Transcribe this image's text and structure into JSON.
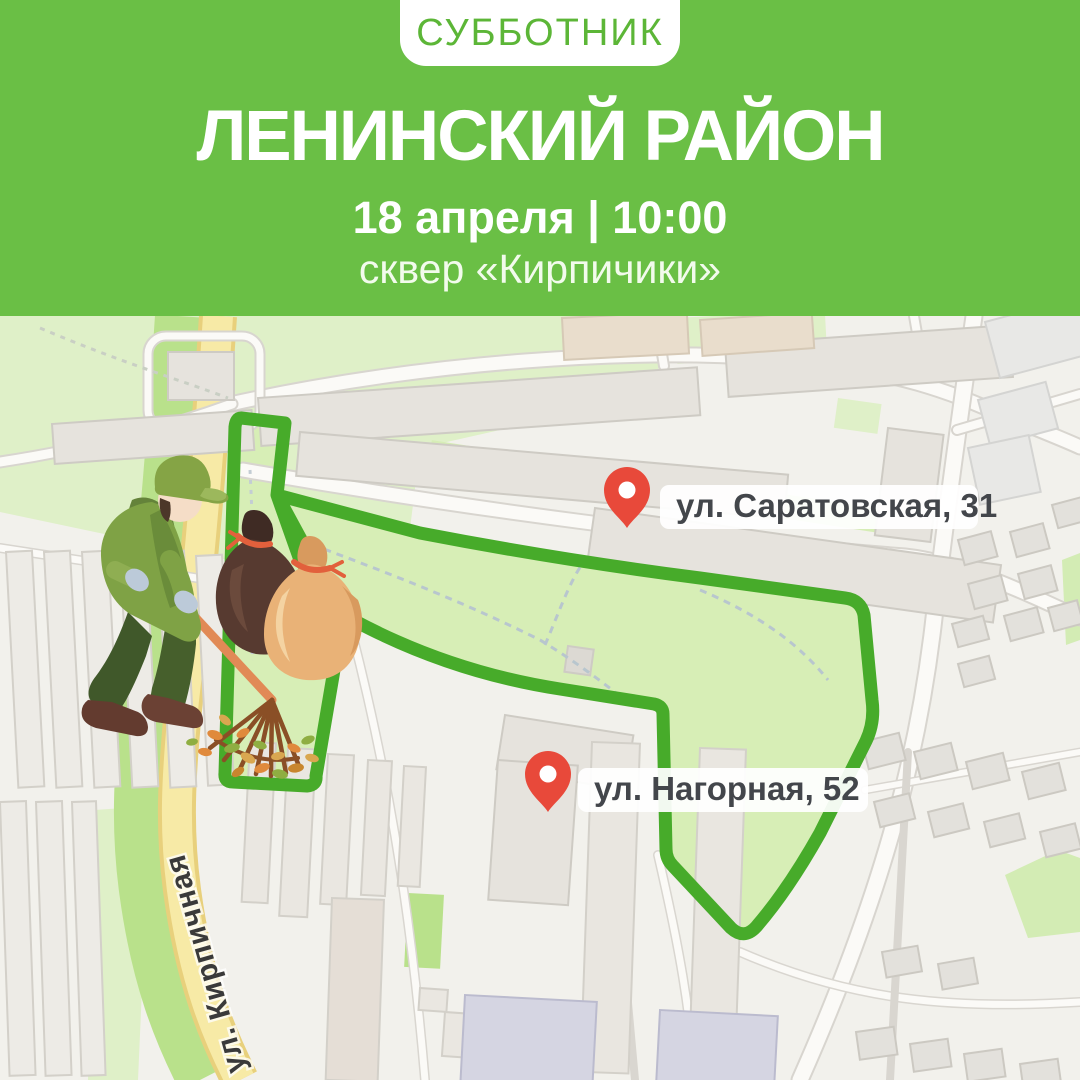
{
  "header": {
    "badge": "СУББОТНИК",
    "title": "ЛЕНИНСКИЙ РАЙОН",
    "datetime": "18 апреля | 10:00",
    "location": "сквер «Кирпичики»"
  },
  "map": {
    "pins": [
      {
        "label": "ул. Саратовская, 31"
      },
      {
        "label": "ул. Нагорная, 52"
      }
    ],
    "street_label": "ул. Кирпичная"
  },
  "colors": {
    "header_green": "#6abf45",
    "badge_text_green": "#5cb637",
    "route_stroke_green": "#47ab2a",
    "route_fill_green": "#d7eeb6",
    "park_green": "#dff0c8",
    "roadside_green": "#b9e18b",
    "road_yellow": "#f7eaa6",
    "pin_red": "#e8493a",
    "pin_label_text": "#43464b"
  }
}
